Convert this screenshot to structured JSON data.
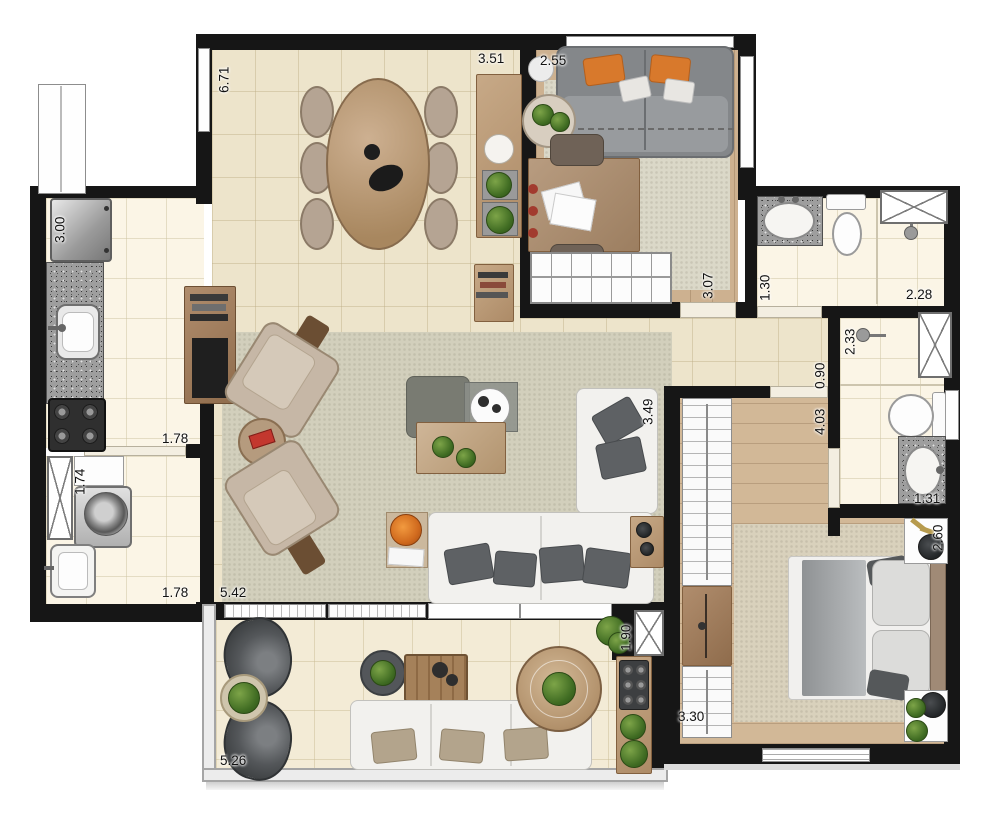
{
  "meta": {
    "type": "apartment-floor-plan"
  },
  "palette": {
    "wall": "#161616",
    "tile_floor": "#ede4cb",
    "wet_floor": "#fbf5e6",
    "wood_floor": "#cdb190",
    "balcony_floor": "#f3ebd6",
    "rug": "#d2cfbc",
    "granite": "#9e9e9e",
    "sofa_white": "#f2f1ee",
    "pillow_gray": "#5e6164",
    "accent_orange": "#d8792c",
    "plant_green": "#3f6b22",
    "furniture_wood": "#b99a78"
  },
  "dimensions_m": {
    "dining_depth": "6.71",
    "dining_width": "3.51",
    "office_width": "2.55",
    "office_depth": "3.07",
    "kitchen_depth": "3.00",
    "kitchen_width": "1.78",
    "laundry_depth": "1.74",
    "laundry_width": "1.78",
    "living_width": "5.42",
    "living_depth": "3.49",
    "bath1_depth": "1.30",
    "bath1_width": "2.28",
    "bath2_depth": "2.33",
    "hall_width": "0.90",
    "bedroom_depth": "4.03",
    "bath2_width": "1.31",
    "bedroom_side_depth": "2.60",
    "bedroom_width": "3.30",
    "balcony_depth": "1.90",
    "balcony_width": "5.26"
  }
}
